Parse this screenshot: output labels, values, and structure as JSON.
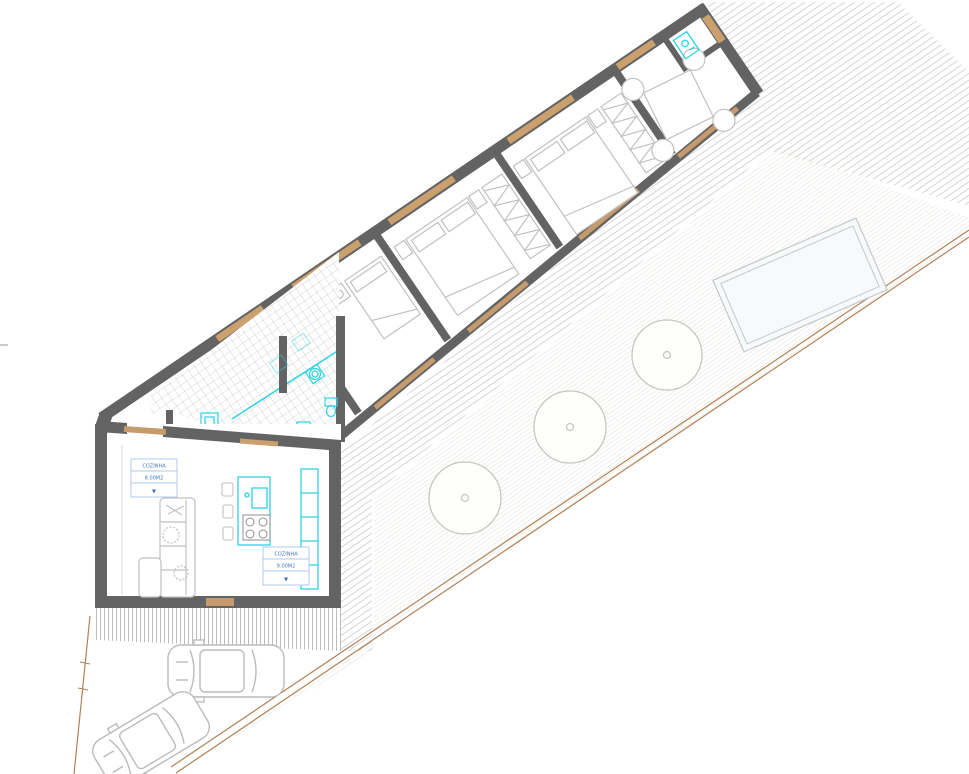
{
  "drawing": {
    "kind": "architectural site / floor plan",
    "labels": {
      "label1": {
        "title": "COZINHA",
        "area": "8.00M2",
        "symbol": "▼"
      },
      "label2": {
        "title": "COZINHA",
        "area": "9.00M2",
        "symbol": "▼"
      }
    },
    "colors": {
      "wall": "#636363",
      "wood_door": "#c59a6d",
      "fixture_cyan": "#2ed2e2",
      "label_blue": "#4479c4",
      "label_border": "#a8c6ec",
      "furniture_gray": "#c3c1bf",
      "boundary_brown": "#b28257",
      "tile_line": "#b2b2b2",
      "deck_line": "#d8d5d1",
      "pool_fill": "#f6fafb"
    },
    "counts": {
      "trees": 3,
      "cars": 2,
      "bedrooms": 3
    },
    "elements": [
      "living-room",
      "kitchen-island",
      "sofa",
      "bathroom-tiled-area",
      "washing-machine",
      "bedroom-single",
      "bedroom-double-1",
      "bedroom-double-2",
      "dining-room",
      "wc",
      "deck",
      "lawn",
      "pool",
      "trees",
      "cars",
      "site-boundary"
    ]
  }
}
